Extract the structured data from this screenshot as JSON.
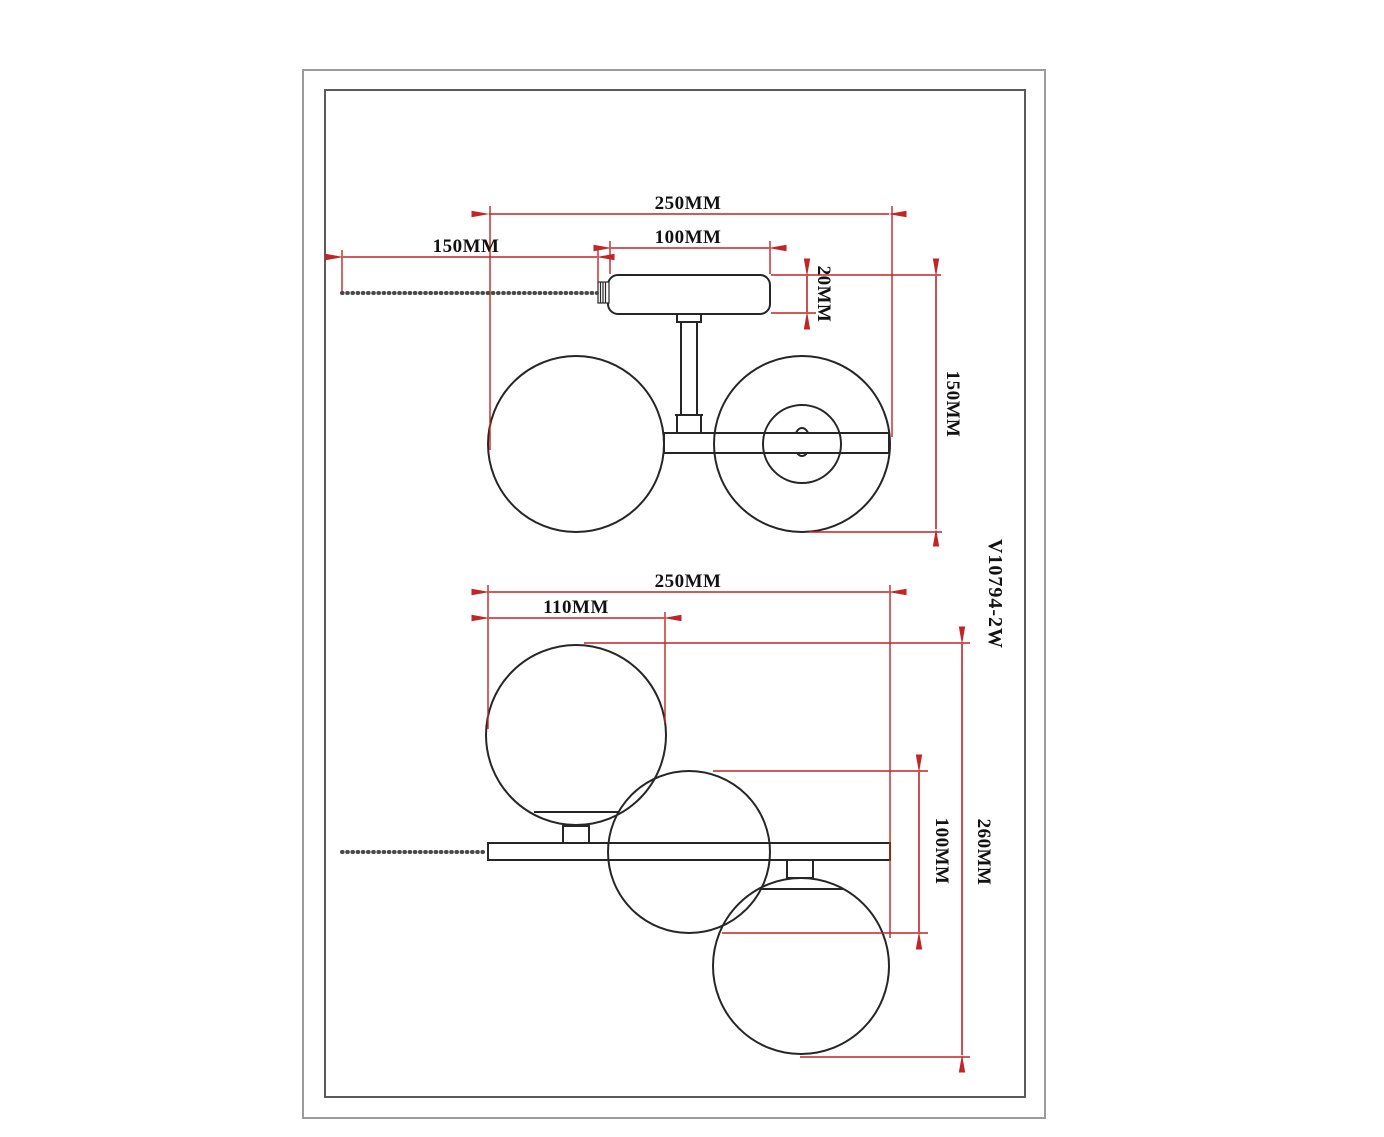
{
  "part_number": "V10794-2W",
  "colors": {
    "dimension": "#c22527",
    "line": "#262626",
    "text": "#121212",
    "chain": "#4a4a4a",
    "border_outer": "#9b9b9b",
    "border_inner": "#5a5a5a"
  },
  "top_view": {
    "labels": {
      "overall_width": "250MM",
      "chain_length": "150MM",
      "canopy_width": "100MM",
      "canopy_height": "20MM",
      "overall_height": "150MM"
    }
  },
  "bottom_view": {
    "labels": {
      "overall_width": "250MM",
      "globe_offset": "110MM",
      "globe_diameter": "100MM",
      "overall_height": "260MM"
    }
  }
}
